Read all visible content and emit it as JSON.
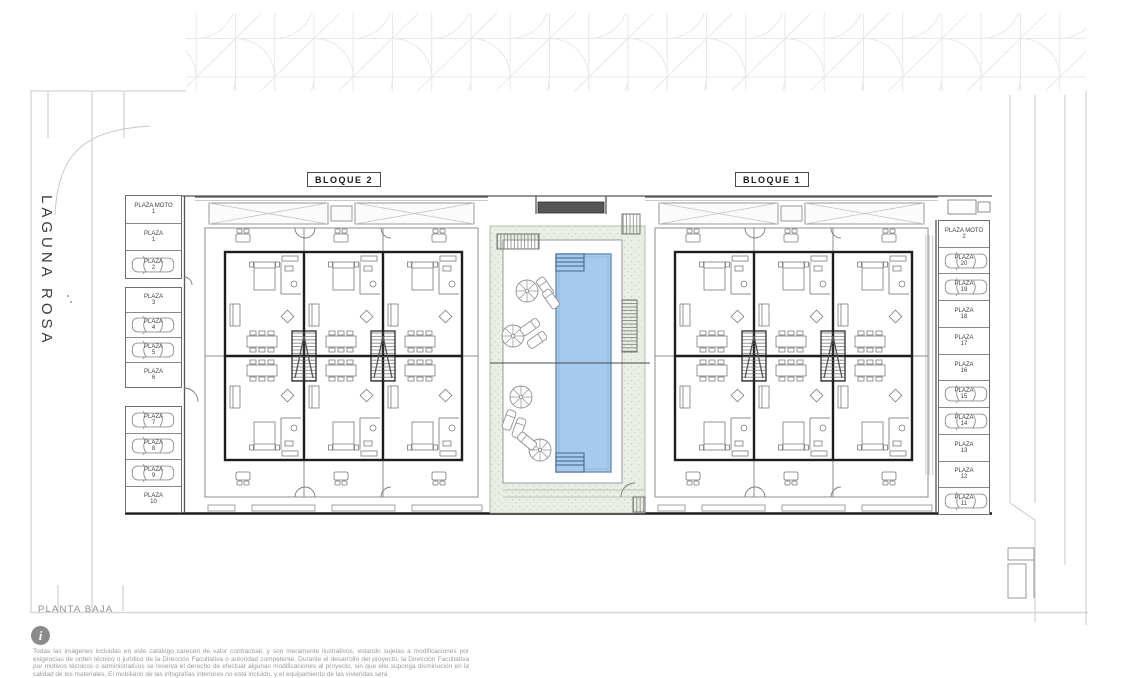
{
  "street": {
    "label": "LAGUNA ROSA"
  },
  "blocks": {
    "left": "BLOQUE 2",
    "right": "BLOQUE 1"
  },
  "floor": {
    "label": "PLANTA BAJA"
  },
  "parking": {
    "left_groups": [
      [
        {
          "label": "PLAZA MOTO",
          "num": "1",
          "car": false
        },
        {
          "label": "PLAZA",
          "num": "1",
          "car": false
        },
        {
          "label": "PLAZA",
          "num": "2",
          "car": true
        }
      ],
      [
        {
          "label": "PLAZA",
          "num": "3",
          "car": false
        },
        {
          "label": "PLAZA",
          "num": "4",
          "car": true
        },
        {
          "label": "PLAZA",
          "num": "5",
          "car": true
        },
        {
          "label": "PLAZA",
          "num": "6",
          "car": false
        }
      ],
      [
        {
          "label": "PLAZA",
          "num": "7",
          "car": true
        },
        {
          "label": "PLAZA",
          "num": "8",
          "car": true
        },
        {
          "label": "PLAZA",
          "num": "9",
          "car": true
        },
        {
          "label": "PLAZA",
          "num": "10",
          "car": false
        }
      ]
    ],
    "right_groups": [
      [
        {
          "label": "PLAZA MOTO",
          "num": "2",
          "car": false
        },
        {
          "label": "PLAZA",
          "num": "20",
          "car": true
        },
        {
          "label": "PLAZA",
          "num": "19",
          "car": true
        },
        {
          "label": "PLAZA",
          "num": "18",
          "car": false
        },
        {
          "label": "PLAZA",
          "num": "17",
          "car": false
        },
        {
          "label": "PLAZA",
          "num": "16",
          "car": false
        },
        {
          "label": "PLAZA",
          "num": "15",
          "car": true
        },
        {
          "label": "PLAZA",
          "num": "14",
          "car": true
        },
        {
          "label": "PLAZA",
          "num": "13",
          "car": false
        },
        {
          "label": "PLAZA",
          "num": "12",
          "car": false
        },
        {
          "label": "PLAZA",
          "num": "11",
          "car": true
        }
      ]
    ]
  },
  "footer": {
    "info_icon": "i",
    "disclaimer": "Todas las imágenes incluidas en este catálogo carecen de valor contractual, y son meramente ilustrativos, estando sujetas a modificaciones por exigencias de orden técnico o jurídico de la Dirección Facultativa o autoridad competente. Durante el desarrollo del proyecto, la Dirección Facultativa por motivos técnicos o administrativos se reserva el derecho de efectuar algunas modificaciones al proyecto, sin que ello suponga disminución en la calidad de los materiales. El mobiliario de las infografías interiores no está incluido, y el equipamiento de las viviendas será"
  },
  "colors": {
    "pool_fill": "#a6c9ee",
    "pool_edge": "#6b8fb5",
    "lawn": "#e9efe4",
    "wall": "#1d1d1d",
    "road_line": "#c9c9c9",
    "text_muted": "#9b9b9b"
  }
}
